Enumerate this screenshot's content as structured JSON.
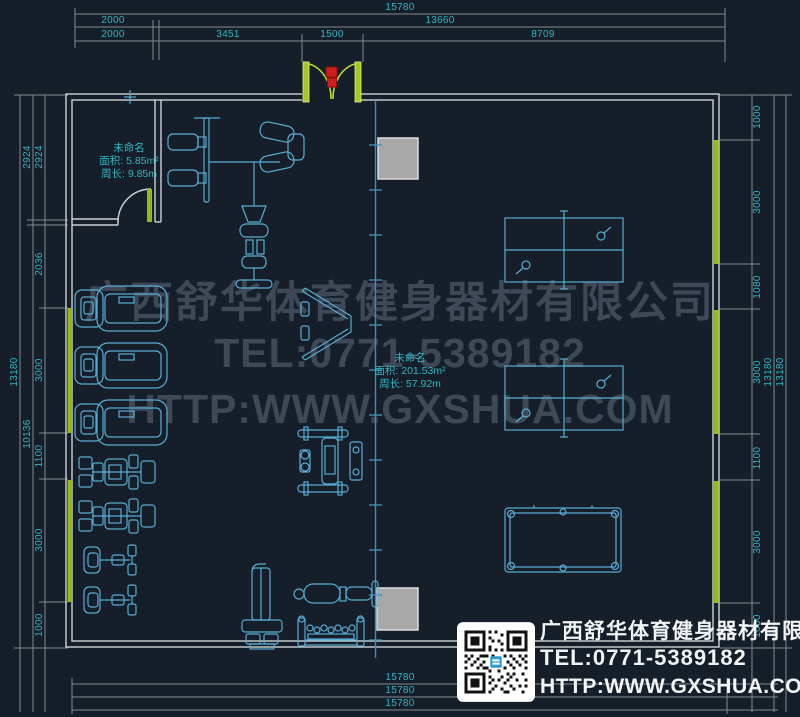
{
  "drawing": {
    "type": "gym-floor-plan",
    "unit": "mm"
  },
  "watermark": {
    "line1": "广西舒华体育健身器材有限公司",
    "line2": "TEL:0771-5389182",
    "line3": "HTTP:WWW.GXSHUA.COM"
  },
  "title_block": {
    "company": "广西舒华体育健身器材有限公司",
    "tel": "TEL:0771-5389182",
    "url": "HTTP:WWW.GXSHUA.COM"
  },
  "room_labels": {
    "small_room": {
      "name": "未命名",
      "area": "面积: 5.85m²",
      "perimeter": "周长: 9.85m"
    },
    "main_room": {
      "name": "未命名",
      "area": "面积: 201.53m²",
      "perimeter": "周长: 57.92m"
    }
  },
  "dimensions": {
    "unit": "mm",
    "top_chain_1": [
      "15780"
    ],
    "top_chain_2": [
      "2000",
      "13660"
    ],
    "top_chain_3": [
      "2000",
      "3451",
      "1500",
      "8709"
    ],
    "bottom_chains": [
      "15780",
      "15780",
      "15780"
    ],
    "left_chain_inner": [
      "2924",
      "2036",
      "3000",
      "1100",
      "3000",
      "1000"
    ],
    "left_chain_mid": [
      "2924",
      "10136"
    ],
    "left_chain_outer": [
      "13180"
    ],
    "right_chain_inner": [
      "1000",
      "3000",
      "1080",
      "3000",
      "1100",
      "3000",
      "1000"
    ],
    "right_chain_outer": [
      "13180",
      "13180"
    ],
    "labels": [
      {
        "t": "15780",
        "x": 400,
        "y": 8
      },
      {
        "t": "2000",
        "x": 113,
        "y": 21
      },
      {
        "t": "13660",
        "x": 440,
        "y": 21
      },
      {
        "t": "2000",
        "x": 113,
        "y": 35
      },
      {
        "t": "3451",
        "x": 228,
        "y": 35
      },
      {
        "t": "1500",
        "x": 332,
        "y": 35
      },
      {
        "t": "8709",
        "x": 543,
        "y": 35
      },
      {
        "t": "15780",
        "x": 400,
        "y": 678
      },
      {
        "t": "15780",
        "x": 400,
        "y": 691
      },
      {
        "t": "15780",
        "x": 400,
        "y": 704
      },
      {
        "t": "2924",
        "x": 40,
        "y": 157,
        "r": 1
      },
      {
        "t": "2036",
        "x": 40,
        "y": 264,
        "r": 1
      },
      {
        "t": "3000",
        "x": 40,
        "y": 370,
        "r": 1
      },
      {
        "t": "1100",
        "x": 40,
        "y": 456,
        "r": 1
      },
      {
        "t": "3000",
        "x": 40,
        "y": 540,
        "r": 1
      },
      {
        "t": "1000",
        "x": 40,
        "y": 625,
        "r": 1
      },
      {
        "t": "2924",
        "x": 28,
        "y": 157,
        "r": 1
      },
      {
        "t": "10136",
        "x": 28,
        "y": 434,
        "r": 1
      },
      {
        "t": "13180",
        "x": 15,
        "y": 372,
        "r": 1
      },
      {
        "t": "1000",
        "x": 758,
        "y": 117,
        "r": 1
      },
      {
        "t": "3000",
        "x": 758,
        "y": 202,
        "r": 1
      },
      {
        "t": "1080",
        "x": 758,
        "y": 287,
        "r": 1
      },
      {
        "t": "3000",
        "x": 758,
        "y": 372,
        "r": 1
      },
      {
        "t": "1100",
        "x": 758,
        "y": 458,
        "r": 1
      },
      {
        "t": "3000",
        "x": 758,
        "y": 542,
        "r": 1
      },
      {
        "t": "1000",
        "x": 758,
        "y": 626,
        "r": 1
      },
      {
        "t": "13180",
        "x": 769,
        "y": 372,
        "r": 1
      },
      {
        "t": "13180",
        "x": 781,
        "y": 372,
        "r": 1
      }
    ]
  },
  "colors": {
    "background": "#151e29",
    "wall": "#ccd1d6",
    "equipment": "#58aed6",
    "dimension_line": "#82898f",
    "dimension_text": "#2cb9c6",
    "window_wall": "#95ba15",
    "door_jamb": "#b9d63a",
    "door_marker": "#cf1d1d",
    "column_fill": "#a8a8a8",
    "grid_line": "#3f8fb8",
    "watermark_text": "rgba(158,173,192,0.30)",
    "title_text": "#f3f4f5"
  }
}
